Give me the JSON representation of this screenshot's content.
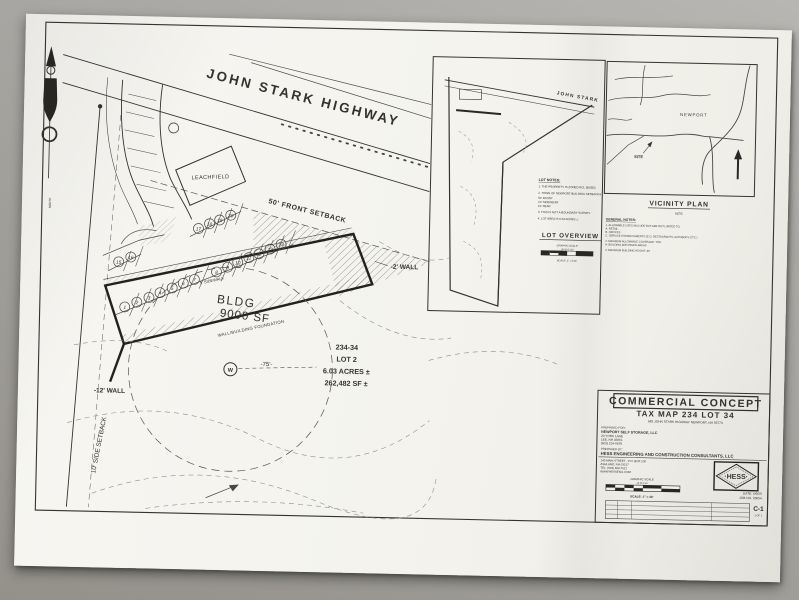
{
  "photo": {
    "background": "#a8a6a2",
    "paper_color": "#f5f4ef",
    "ink": "#35332e"
  },
  "plan": {
    "highway_label": "JOHN STARK HIGHWAY",
    "leachfield_label": "LEACHFIELD",
    "front_setback_label": "50' FRONT SETBACK",
    "sidewalk_label": "5' SIDEWALK",
    "bldg_line1": "BLDG",
    "bldg_line2": "9000 SF",
    "foundation_label": "WALL/BUILDING FOUNDATION",
    "wall_right_label": "-2' WALL",
    "wall_left_label": "-12' WALL",
    "side_setback_label": "10' SIDE SETBACK",
    "well_label": "W",
    "well_radius_label": "-75'-",
    "north_label": "NORTH",
    "lot_info": [
      "234-34",
      "LOT 2",
      "6.03 ACRES ±",
      "262,482 SF ±"
    ],
    "stalls": [
      "1",
      "2",
      "3",
      "4",
      "5",
      "6",
      "7",
      "8",
      "9",
      "10",
      "11",
      "12",
      "13",
      "14",
      "15",
      "16",
      "17",
      "18",
      "19",
      "20"
    ]
  },
  "lot_overview": {
    "road_label": "JOHN STARK",
    "notes_title": "LOT NOTES:",
    "notes": [
      "1.  THE PROPERTY IS ZONED RCL (B1/B2).",
      "2.  TOWN OF NEWPORT BUILDING SETBACKS:",
      "        50'  FRONT",
      "        10'  SIDE/REAR",
      "        10'  REAR",
      "3.  THIS IS NOT A BOUNDARY SURVEY.",
      "4.  LOT AREA IS 6.03 ACRES ±."
    ],
    "title": "LOT OVERVIEW",
    "scale_label": "GRAPHIC SCALE",
    "scale_numbers": "100     50     0     100",
    "scale_text": "SCALE: 1\" = 100'"
  },
  "vicinity": {
    "town_label": "NEWPORT",
    "site_label": "SITE",
    "title": "VICINITY PLAN",
    "nts": "NTS",
    "notes_title": "GENERAL NOTES:",
    "notes": [
      "1.  ALLOWABLE USES INCLUDE BUT ARE NOT LIMITED TO:",
      "        A.  RETAIL",
      "        B.  OFFICES",
      "        C.  SERVICE ESTABLISHMENTS (E.G. RESTAURANTS, AUTOBODY, ETC.)",
      "2.  MAXIMUM ALLOWABLE COVERAGE: 70%",
      "        A.  BUILDING AND PAVED AREAS",
      "3.  MAXIMUM BUILDING HEIGHT: 40'"
    ]
  },
  "title_block": {
    "title": "COMMERCIAL CONCEPT",
    "subtitle": "TAX MAP 234   LOT 34",
    "address": "682 JOHN STARK HIGHWAY   NEWPORT, NH 03773",
    "prepared_for_label": "PREPARED FOR:",
    "prepared_for": [
      "NEWPORT SELF STORAGE, LLC",
      "20 YORK LANE",
      "LEE, NH 03861",
      "(603) 234-5678"
    ],
    "prepared_by_label": "PREPARED BY:",
    "prepared_by": "HESS ENGINEERING AND CONSTRUCTION CONSULTANTS, LLC",
    "prepared_by_address": [
      "140 MAIN STREET  -  P.O. BOX 100",
      "ASHLAND, NH 03217",
      "TEL: (603) 968-7021",
      "WWW.HESSENG.COM"
    ],
    "logo_text": "·HESS·",
    "scale_label": "GRAPHIC SCALE",
    "scale_numbers": "40    20    0    40",
    "scale_text": "SCALE: 1\" = 40'",
    "date": "DATE: 4/9/25",
    "job_no": "JOB NO. 25054",
    "sheet_no": "C-1",
    "sheet_of": "1 OF 1"
  }
}
